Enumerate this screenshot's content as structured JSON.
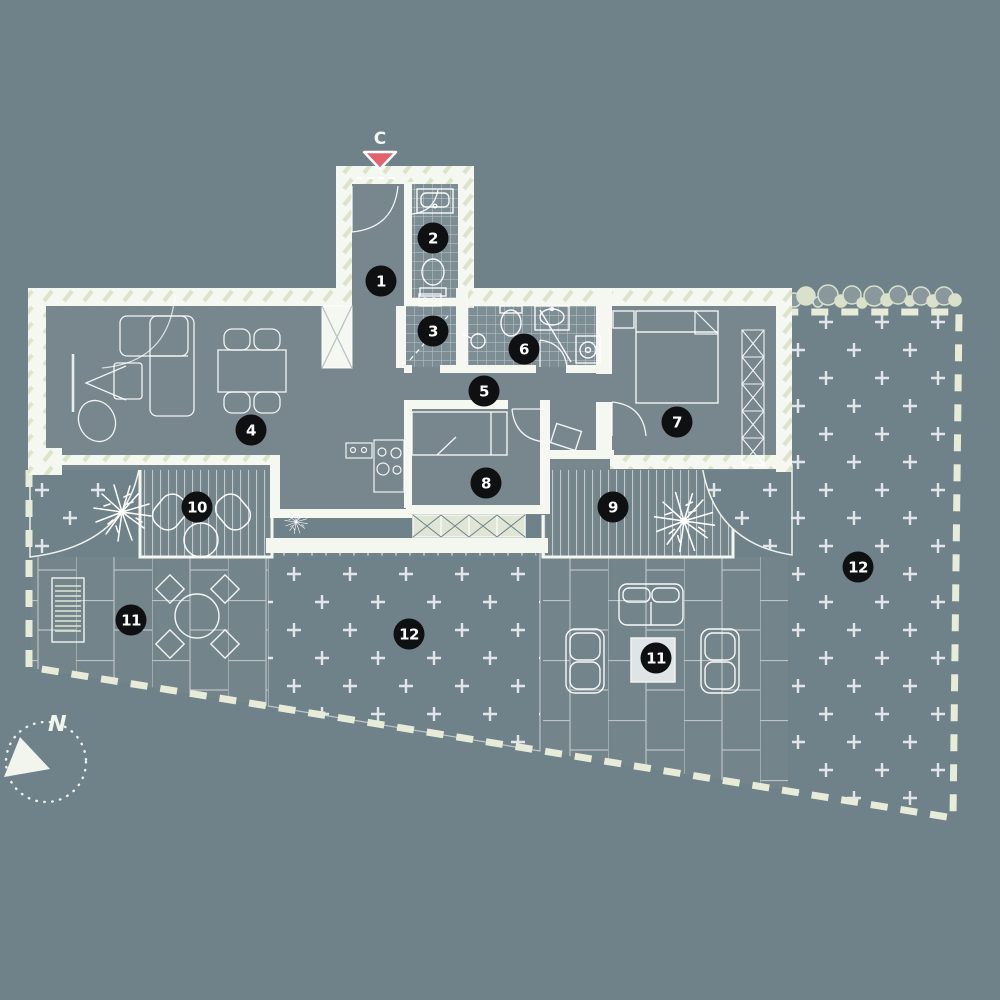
{
  "compass": {
    "label": "N"
  },
  "entrance": {
    "label": "C"
  },
  "markers": [
    {
      "label": "1",
      "x": 381,
      "y": 281
    },
    {
      "label": "2",
      "x": 433,
      "y": 238
    },
    {
      "label": "3",
      "x": 433,
      "y": 331
    },
    {
      "label": "4",
      "x": 251,
      "y": 430
    },
    {
      "label": "5",
      "x": 484,
      "y": 391
    },
    {
      "label": "6",
      "x": 524,
      "y": 349
    },
    {
      "label": "7",
      "x": 677,
      "y": 422
    },
    {
      "label": "8",
      "x": 486,
      "y": 483
    },
    {
      "label": "9",
      "x": 613,
      "y": 507
    },
    {
      "label": "10",
      "x": 197,
      "y": 507
    },
    {
      "label": "11",
      "x": 131,
      "y": 620
    },
    {
      "label": "12",
      "x": 409,
      "y": 634
    },
    {
      "label": "11",
      "x": 656,
      "y": 658
    },
    {
      "label": "12",
      "x": 858,
      "y": 567
    }
  ],
  "colors": {
    "background": "#6f828a",
    "floor": "#77878d",
    "tile_floor": "#7d8d94",
    "wall": "#f5f7f1",
    "wall_hatch": "#dbe3c8",
    "boundary_dash": "#e6ecd8",
    "line": "#ffffff",
    "marker_bg": "#0e1011",
    "marker_text": "#ffffff",
    "entrance_triangle": "#e2636e"
  }
}
